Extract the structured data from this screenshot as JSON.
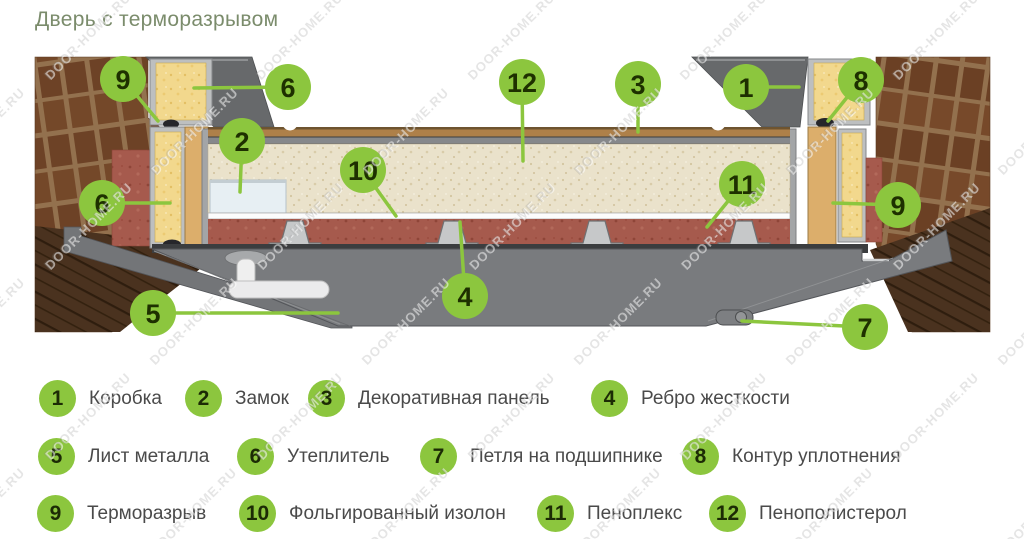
{
  "title": "Дверь с терморазрывом",
  "watermark": {
    "text": "DOOR-HOME.RU"
  },
  "colors": {
    "accent_green": "#8cc63e",
    "callout_number": "#1e3000",
    "title_color": "#7b8c6c",
    "legend_text": "#4a4a4a",
    "brick": "#6d4226",
    "insulation_yellow": "#f2d88d",
    "penoplex_red": "#a65a4d",
    "polystyrene_cream": "#eae2cb",
    "metal_gray": "#797b7e",
    "wood_tan": "#dcae6b"
  },
  "diagram": {
    "callouts": [
      {
        "n": "9",
        "part": "терморазрыв (слева)"
      },
      {
        "n": "6",
        "part": "утеплитель (верх)"
      },
      {
        "n": "12",
        "part": "пенополистерол"
      },
      {
        "n": "3",
        "part": "декоративная панель"
      },
      {
        "n": "1",
        "part": "коробка"
      },
      {
        "n": "8",
        "part": "контур уплотнения"
      },
      {
        "n": "2",
        "part": "замок"
      },
      {
        "n": "10",
        "part": "фольгированный изолон"
      },
      {
        "n": "11",
        "part": "пеноплекс"
      },
      {
        "n": "6",
        "part": "утеплитель (коробка слева)"
      },
      {
        "n": "9",
        "part": "терморазрыв (справа)"
      },
      {
        "n": "4",
        "part": "ребро жесткости"
      },
      {
        "n": "5",
        "part": "лист металла"
      },
      {
        "n": "7",
        "part": "петля на подшипнике"
      }
    ]
  },
  "legend": {
    "items": [
      {
        "n": "1",
        "label": "Коробка"
      },
      {
        "n": "2",
        "label": "Замок"
      },
      {
        "n": "3",
        "label": "Декоративная панель"
      },
      {
        "n": "4",
        "label": "Ребро жесткости"
      },
      {
        "n": "5",
        "label": "Лист металла"
      },
      {
        "n": "6",
        "label": "Утеплитель"
      },
      {
        "n": "7",
        "label": "Петля на подшипнике"
      },
      {
        "n": "8",
        "label": "Контур уплотнения"
      },
      {
        "n": "9",
        "label": "Терморазрыв"
      },
      {
        "n": "10",
        "label": "Фольгированный изолон"
      },
      {
        "n": "11",
        "label": "Пеноплекс"
      },
      {
        "n": "12",
        "label": "Пенополистерол"
      }
    ]
  }
}
